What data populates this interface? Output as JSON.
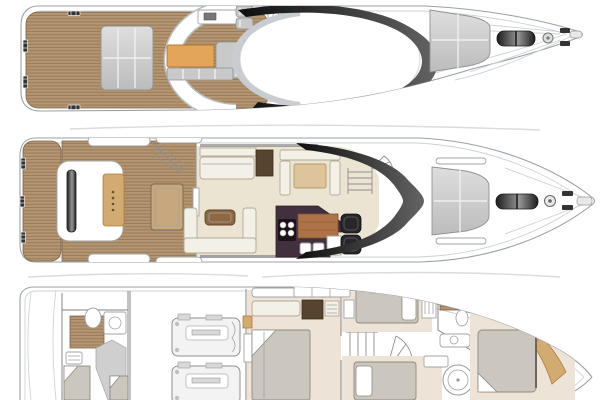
{
  "diagram": {
    "kind": "yacht-general-arrangement",
    "views": "3",
    "decks": [
      {
        "id": "flybridge",
        "label": "Flybridge deck plan: aft teak deck with sunpad, radar arch, flybridge seating with orange pad, helm seats, wet bar, hardtop with dark windscreen, foredeck sunpad, windlass and anchor gear"
      },
      {
        "id": "main-deck",
        "label": "Main deck plan: teak swim platform, transom sunbed, cockpit with teak table and stairs, saloon sofas, dinette, galley with hob and sinks, twin helm seats, companionway stairs, dark wraparound windscreen, bow sunpad, windlass and anchor gear"
      },
      {
        "id": "lower-deck",
        "label": "Lower deck plan: crew cabin with shower and berths, engine room with twin engines, midship double cabin, staircase, twin guest cabins, two bathrooms with showers, forward VIP cabin with double bed"
      }
    ]
  },
  "palette": {
    "hull-line": "#9aa0a6",
    "hull-line-light": "#cdd1d6",
    "ghost-line": "#d9dbde",
    "teak": "#b4956f",
    "teak-line": "#96795b",
    "teak-edge": "#7e6548",
    "teak-light": "#c7a87e",
    "cushion": "#c9c9c9",
    "cushion-edge": "#919191",
    "seam": "#efefef",
    "pad-a": "#dedede",
    "pad-b": "#bcbcbc",
    "orange": "#e2a55a",
    "orange-edge": "#b07c3a",
    "cream": "#ebe4d3",
    "lower-floor": "#ede3d7",
    "sofa": "#f3f0e7",
    "sofa-edge": "#b3aa97",
    "dark-wood": "#57442f",
    "tan-pad": "#d2ab72",
    "table-wood": "#8d6843",
    "galley": "#43303f",
    "counter-wood": "#ad7347",
    "glass-a": "#0e0e0e",
    "glass-b": "#636363",
    "seat-black": "#27272a",
    "bed": "#cbc7bf",
    "bed-edge": "#8e8a80",
    "metal-a": "#1c1c1c",
    "metal-b": "#969696",
    "fixture-edge": "#a3a3a3",
    "wall-line": "#9a9a9a",
    "wall-fill": "#cfcfcf"
  }
}
